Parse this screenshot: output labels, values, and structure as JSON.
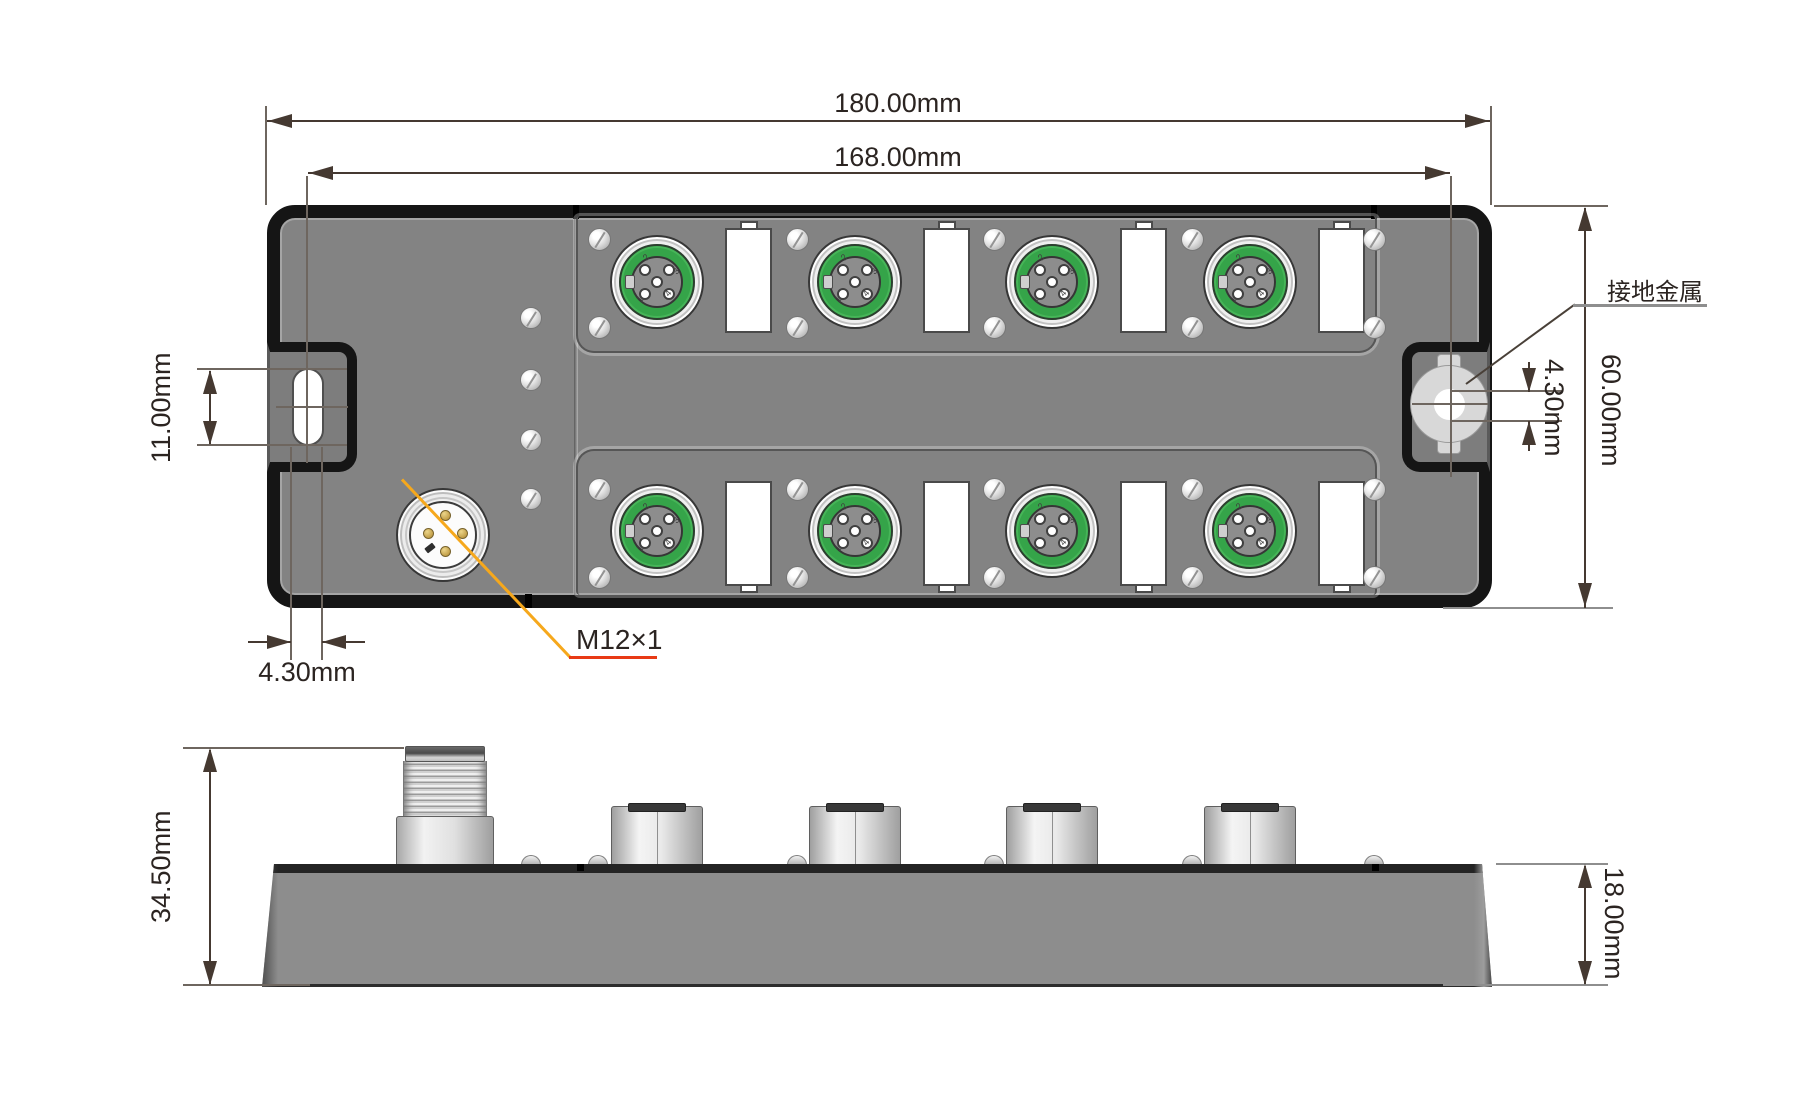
{
  "top_view": {
    "dims": {
      "width_outer": "180.00mm",
      "width_inner": "168.00mm",
      "slot_length": "11.00mm",
      "slot_width": "4.30mm",
      "ground_hole": "4.30mm",
      "body_height": "60.00mm"
    },
    "labels": {
      "grounding_metal": "接地金属",
      "connector_thread": "M12×1"
    },
    "pin_labels": [
      "1",
      "2",
      "3",
      "4"
    ]
  },
  "side_view": {
    "dims": {
      "total_height": "34.50mm",
      "body_height": "18.00mm"
    }
  },
  "colors": {
    "body_gray": "#838383",
    "connector_green": "#35a449",
    "metal_silver": "#d8d8d8",
    "leader_orange": "#f6a81c",
    "underline_red": "#e83a15",
    "dim_line": "#453931",
    "text": "#2b2421"
  }
}
